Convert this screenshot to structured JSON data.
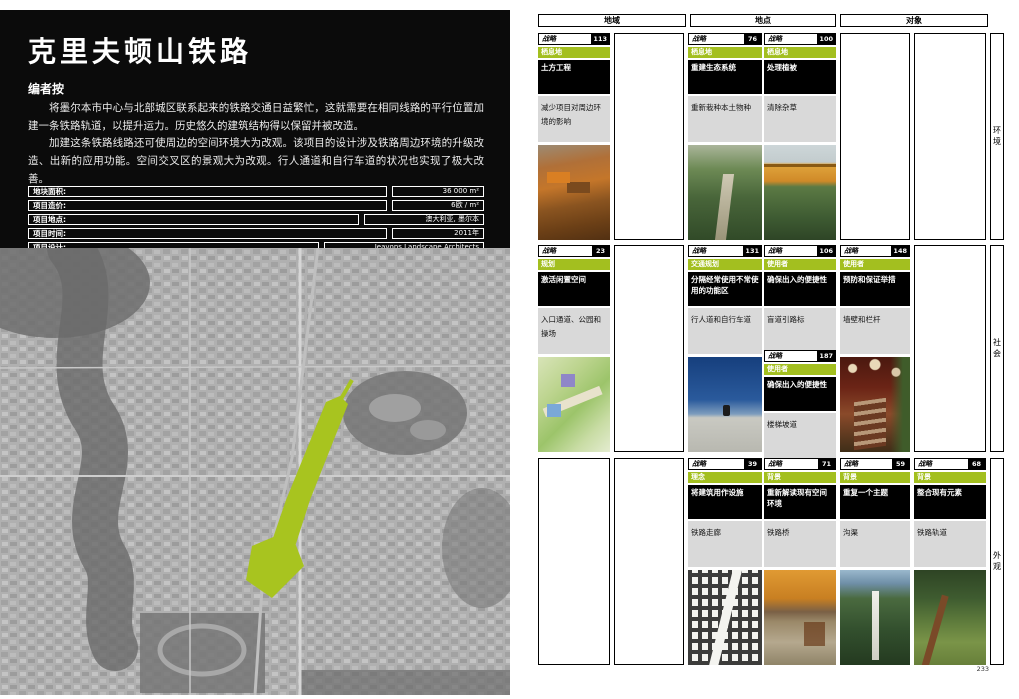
{
  "left_page": {
    "title": "克里夫顿山铁路",
    "section_heading": "编者按",
    "paragraphs": [
      "将墨尔本市中心与北部城区联系起来的铁路交通日益繁忙，这就需要在相同线路的平行位置加建一条铁路轨道，以提升运力。历史悠久的建筑结构得以保留并被改造。",
      "加建这条铁路线路还可使周边的空间环境大为改观。该项目的设计涉及铁路周边环境的升级改造、出新的应用功能。空间交叉区的景观大为改观。行人通道和自行车道的状况也实现了极大改善。"
    ],
    "info_table": [
      {
        "label": "地块面积:",
        "value": "36 000 m²"
      },
      {
        "label": "项目造价:",
        "value": "6欧 / m²"
      },
      {
        "label": "项目地点:",
        "value": "澳大利亚, 墨尔本"
      },
      {
        "label": "项目时间:",
        "value": "2011年"
      },
      {
        "label": "项目设计:",
        "value": "Jeavons Landscape Architects"
      }
    ],
    "map": {
      "highlight_color": "#a8c41f",
      "description": "aerial-map-with-green-rail-corridor"
    }
  },
  "right_page": {
    "strategy_label": "战略",
    "column_headers": [
      "地域",
      "地点",
      "对象"
    ],
    "row_labels": [
      "环境",
      "社会",
      "外观"
    ],
    "page_number": "233",
    "accent_color": "#a3bf1f",
    "cards": [
      {
        "number": "113",
        "category": "栖息地",
        "title": "土方工程",
        "desc": "减少项目对周边环境的影响",
        "photo": "earthworks-photo"
      },
      {
        "number": "76",
        "category": "栖息地",
        "title": "重建生态系统",
        "desc": "重新栽种本土物种",
        "photo": "green-boardwalk-photo"
      },
      {
        "number": "100",
        "category": "栖息地",
        "title": "处理植被",
        "desc": "清除杂草",
        "photo": "railway-bridge-photo"
      },
      {
        "number": "23",
        "category": "规划",
        "title": "激活闲置空间",
        "desc": "入口通道、公园和操场",
        "photo": "landscape-plan-image"
      },
      {
        "number": "131",
        "category": "交通规划",
        "title": "分隔经常使用不常使用的功能区",
        "desc": "行人道和自行车道",
        "photo": "skateboarder-photo"
      },
      {
        "number": "106",
        "category": "使用者",
        "title": "确保出入的便捷性",
        "desc": "盲道引路标",
        "photo": null
      },
      {
        "number": "187",
        "category": "使用者",
        "title": "确保出入的便捷性",
        "desc": "楼梯坡道",
        "photo": null
      },
      {
        "number": "148",
        "category": "使用者",
        "title": "预防和保证举措",
        "desc": "墙壁和栏杆",
        "photo": "rusty-stairs-photo"
      },
      {
        "number": "39",
        "category": "理念",
        "title": "将建筑用作设施",
        "desc": "铁路走廊",
        "photo": "bw-city-map-image"
      },
      {
        "number": "71",
        "category": "背景",
        "title": "重新解读现有空间环境",
        "desc": "铁路桥",
        "photo": "under-bridge-photo"
      },
      {
        "number": "59",
        "category": "背景",
        "title": "重复一个主题",
        "desc": "沟渠",
        "photo": "trees-sculpture-photo"
      },
      {
        "number": "68",
        "category": "背景",
        "title": "整合现有元素",
        "desc": "铁路轨道",
        "photo": "overgrown-track-photo"
      }
    ]
  }
}
